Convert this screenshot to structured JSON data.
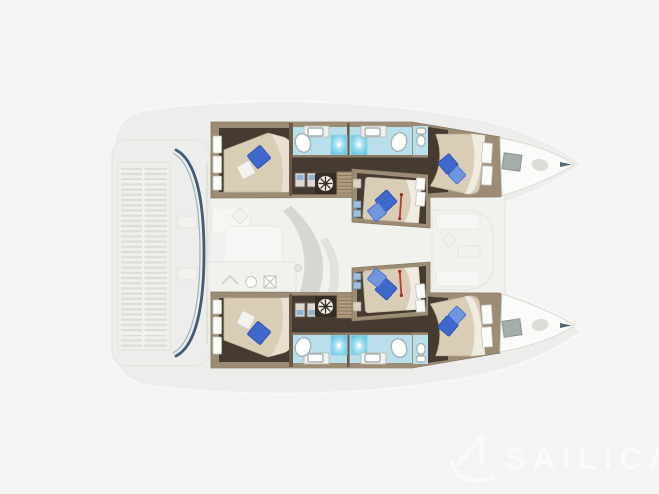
{
  "watermark": {
    "label": "SAILICA",
    "icon": "sailboat-logo-icon"
  },
  "colors": {
    "bg": "#f4f4f2",
    "sil": "#ededeb",
    "sil_line": "#f8f8f6",
    "faint": "#f1f1ee",
    "faint_line": "#e2e2dd",
    "floor": "#463b31",
    "frame": "#9c8c76",
    "frame_dark": "#6b5a4a",
    "bed": "#d9cdb6",
    "bed_hl": "#e9e0cf",
    "blanket": "#f0ece2",
    "pb": "#3f68cd",
    "pbl": "#6f97e0",
    "pw": "#f4f2ec",
    "bath": "#b9dfea",
    "shower_edge": "#8ed2e8",
    "fix_stroke": "#a3b3ba",
    "win": "#fcfcfb",
    "win_stroke": "#c4c4bd",
    "slat": "#dadad5",
    "navy": "#2e4b6d",
    "hatch": "#a7adab",
    "red": "#bb3a2c",
    "swoosh": "#d4d4cf",
    "wm": "#fbfbf9"
  },
  "floorplan": {
    "vessel": "catamaran",
    "view": "top-down interior deck plan, bow to the right",
    "hulls": [
      {
        "name": "port hull (top)",
        "cabins": [
          "aft double cabin",
          "mid double cabin",
          "forward double cabin"
        ],
        "bathrooms": 2
      },
      {
        "name": "starboard hull (bottom)",
        "cabins": [
          "aft double cabin",
          "mid double cabin",
          "forward double cabin"
        ],
        "bathrooms": 2
      }
    ],
    "visible_features": [
      "slatted aft cockpit platform",
      "navy windshield curve at cockpit",
      "salon table and galley (faded)",
      "helm wheel icon",
      "twin staircases into hulls",
      "showers with glass squares",
      "oval and counter sinks",
      "toilets",
      "double beds with blue pillows",
      "red berth ladders",
      "bow deck hatches",
      "foredeck lounge (faded)"
    ]
  }
}
